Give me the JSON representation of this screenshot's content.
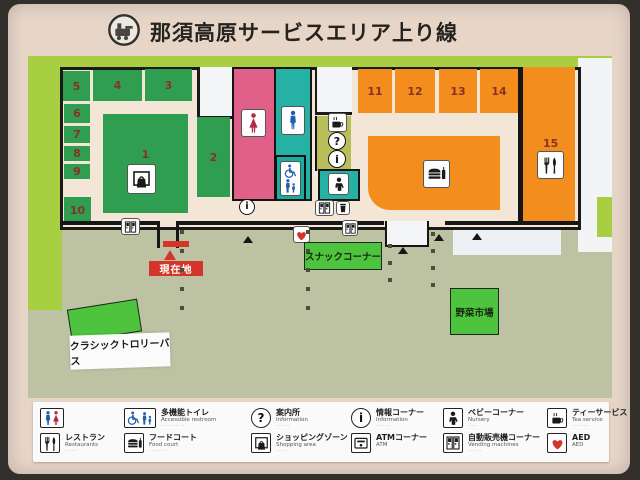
{
  "title": {
    "text": "那須高原サービスエリア上り線"
  },
  "icons": {
    "question": "?",
    "info": "i"
  },
  "map": {
    "units": [
      "1",
      "2",
      "3",
      "4",
      "5",
      "6",
      "7",
      "8",
      "9",
      "10",
      "11",
      "12",
      "13",
      "14",
      "15"
    ],
    "current_location_label": "現在地",
    "snack_corner_label": "スナックコーナー",
    "vegetable_market_label": "野菜市場",
    "trolley_bus_label": "クラシックトロリーバス"
  },
  "legend": {
    "items": [
      {
        "name": "restroom",
        "jp": "",
        "en": "",
        "note": ""
      },
      {
        "name": "restaurant",
        "jp": "レストラン",
        "en": "Restaurants",
        "note": "·····"
      },
      {
        "name": "accessible-restroom",
        "jp": "多機能トイレ",
        "en": "Accessible restroom",
        "note": "··········"
      },
      {
        "name": "food-court",
        "jp": "フードコート",
        "en": "Food court",
        "note": "·······"
      },
      {
        "name": "information-desk",
        "jp": "案内所",
        "en": "Information",
        "note": "······"
      },
      {
        "name": "shopping-zone",
        "jp": "ショッピングゾーン",
        "en": "Shopping area",
        "note": "·····"
      },
      {
        "name": "information-corner",
        "jp": "情報コーナー",
        "en": "Information",
        "note": "······"
      },
      {
        "name": "atm-corner",
        "jp": "ATMコーナー",
        "en": "ATM",
        "note": ""
      },
      {
        "name": "baby-corner",
        "jp": "ベビーコーナー",
        "en": "Nursery",
        "note": "····"
      },
      {
        "name": "vending-machines",
        "jp": "自動販売機コーナー",
        "en": "Vending machines",
        "note": "······"
      },
      {
        "name": "tea-service",
        "jp": "ティーサービス",
        "en": "Tea service",
        "note": "·······"
      },
      {
        "name": "aed",
        "jp": "AED",
        "en": "AED",
        "note": ""
      }
    ]
  }
}
